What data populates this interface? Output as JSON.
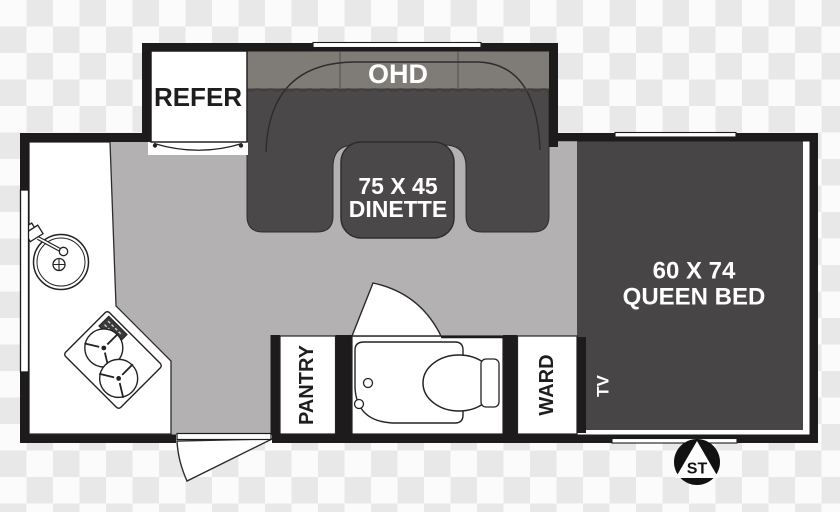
{
  "labels": {
    "refer": "REFER",
    "ohd": "OHD",
    "dinette_size": "75 X 45",
    "dinette": "DINETTE",
    "bed_size": "60 X 74",
    "bed": "QUEEN BED",
    "pantry": "PANTRY",
    "ward": "WARD",
    "tv": "TV",
    "logo": "ST"
  },
  "colors": {
    "wall": "#1d1b1c",
    "floor": "#b3b1b2",
    "furniture_dark": "#4a4849",
    "bed_dark": "#474546",
    "ohd_band": "#7f7c78",
    "fixture_white": "#ffffff",
    "text_light": "#ffffff",
    "text_dark": "#1f1d1e",
    "logo_bg": "#111111"
  }
}
